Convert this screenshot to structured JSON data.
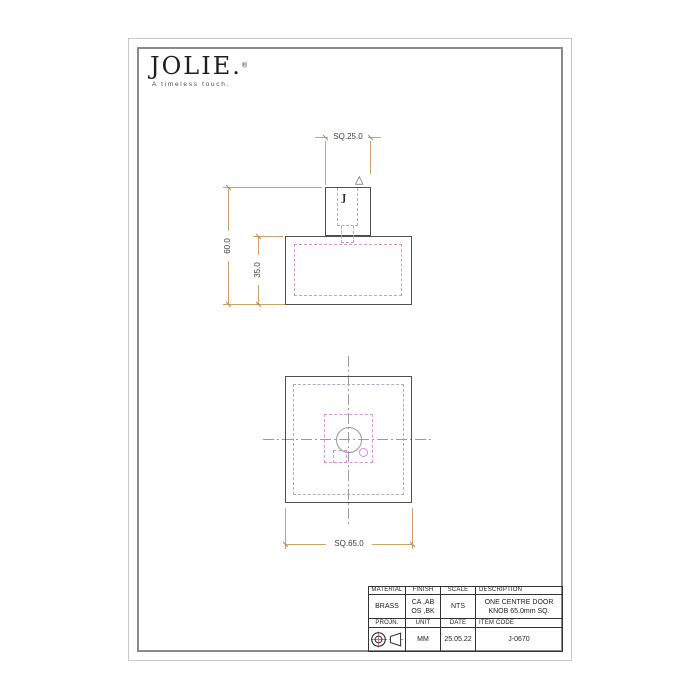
{
  "logo": {
    "brand": "JOLIE.",
    "registered": "®",
    "tagline": "A timeless touch."
  },
  "drawing": {
    "front_view": {
      "dim_top_width": "SQ.25.0",
      "dim_total_height": "60.0",
      "dim_base_height": "35.0",
      "knob_mark": "J",
      "triangle_mark": "△"
    },
    "plan_view": {
      "dim_width": "SQ.65.0"
    }
  },
  "title_block": {
    "headers_row1": [
      "MATERIAL",
      "FINISH",
      "SCALE",
      "DESCRIPTION"
    ],
    "values_row1": {
      "material": "BRASS",
      "finish_line1": "CA ,AB",
      "finish_line2": "OS ,BK",
      "scale": "NTS",
      "description_line1": "ONE CENTRE DOOR",
      "description_line2": "KNOB 65.0mm SQ."
    },
    "headers_row2": [
      "PROJN.",
      "UNIT",
      "DATE",
      "ITEM CODE"
    ],
    "values_row2": {
      "unit": "MM",
      "date": "25.05.22",
      "item_code": "J-0670"
    }
  },
  "colors": {
    "object_line": "#4f4f4f",
    "hidden_line": "#d494d4",
    "dimension_line": "#c9a169",
    "center_line": "#9b9b9b",
    "inset_line": "#b3a9c2",
    "table_line": "#333333",
    "projection_red": "#cc4a4a"
  }
}
